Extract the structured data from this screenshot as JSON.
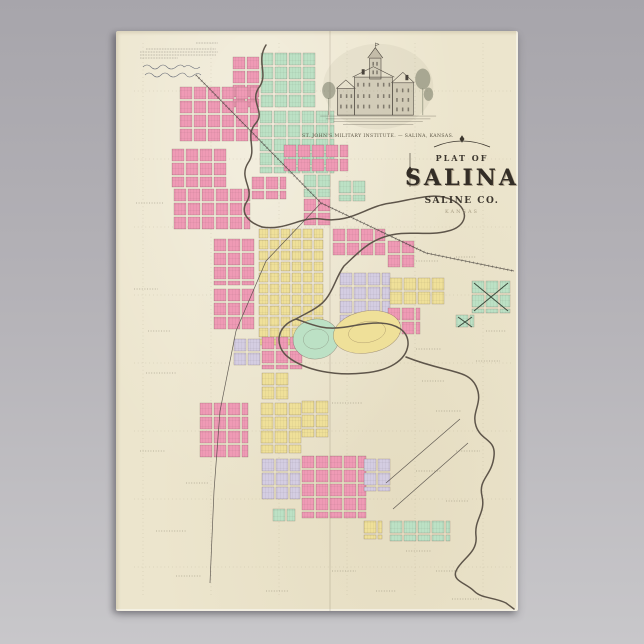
{
  "poster": {
    "title": {
      "plat_of": "PLAT OF",
      "city": "SALINA",
      "county": "SALINE CO.",
      "state": "KANSAS"
    },
    "engraving": {
      "caption": "ST. JOHN'S MILITARY INSTITUTE. — SALINA, KANSAS."
    }
  },
  "map": {
    "palette": {
      "pink": "#ef9ab5",
      "green": "#bce1c5",
      "yellow": "#efe099",
      "lavender": "#d4cde2",
      "paper": "#ece5cd",
      "river": "#5e554a",
      "rail": "#4a4440",
      "lot_line": "rgba(70,45,40,0.42)",
      "section_line": "#8b8266"
    },
    "clusters": [
      {
        "x": 117,
        "y": 26,
        "w": 26,
        "h": 50,
        "c": "pink"
      },
      {
        "x": 145,
        "y": 22,
        "w": 56,
        "h": 56,
        "c": "green"
      },
      {
        "x": 64,
        "y": 56,
        "w": 78,
        "h": 56,
        "c": "pink"
      },
      {
        "x": 144,
        "y": 80,
        "w": 74,
        "h": 62,
        "c": "green"
      },
      {
        "x": 56,
        "y": 118,
        "w": 56,
        "h": 38,
        "c": "pink"
      },
      {
        "x": 58,
        "y": 158,
        "w": 76,
        "h": 42,
        "c": "pink"
      },
      {
        "x": 168,
        "y": 114,
        "w": 64,
        "h": 26,
        "c": "pink"
      },
      {
        "x": 136,
        "y": 146,
        "w": 34,
        "h": 22,
        "c": "pink"
      },
      {
        "x": 188,
        "y": 144,
        "w": 30,
        "h": 22,
        "c": "green"
      },
      {
        "x": 188,
        "y": 168,
        "w": 30,
        "h": 26,
        "c": "pink"
      },
      {
        "x": 223,
        "y": 150,
        "w": 26,
        "h": 20,
        "c": "green"
      },
      {
        "x": 143,
        "y": 198,
        "w": 66,
        "h": 116,
        "c": "yellow",
        "cell": 11
      },
      {
        "x": 98,
        "y": 208,
        "w": 44,
        "h": 46,
        "c": "pink"
      },
      {
        "x": 98,
        "y": 258,
        "w": 44,
        "h": 44,
        "c": "pink"
      },
      {
        "x": 217,
        "y": 198,
        "w": 52,
        "h": 28,
        "c": "pink"
      },
      {
        "x": 272,
        "y": 210,
        "w": 26,
        "h": 26,
        "c": "pink"
      },
      {
        "x": 224,
        "y": 242,
        "w": 50,
        "h": 56,
        "c": "lavender"
      },
      {
        "x": 274,
        "y": 247,
        "w": 56,
        "h": 28,
        "c": "yellow"
      },
      {
        "x": 272,
        "y": 277,
        "w": 32,
        "h": 28,
        "c": "pink"
      },
      {
        "x": 356,
        "y": 250,
        "w": 38,
        "h": 32,
        "c": "green",
        "cem": true
      },
      {
        "x": 340,
        "y": 284,
        "w": 18,
        "h": 14,
        "c": "green",
        "cem": true
      },
      {
        "x": 146,
        "y": 306,
        "w": 44,
        "h": 32,
        "c": "pink"
      },
      {
        "x": 118,
        "y": 308,
        "w": 26,
        "h": 28,
        "c": "lavender"
      },
      {
        "x": 146,
        "y": 342,
        "w": 30,
        "h": 26,
        "c": "yellow"
      },
      {
        "x": 84,
        "y": 372,
        "w": 48,
        "h": 56,
        "c": "pink"
      },
      {
        "x": 145,
        "y": 372,
        "w": 40,
        "h": 50,
        "c": "yellow"
      },
      {
        "x": 186,
        "y": 370,
        "w": 26,
        "h": 36,
        "c": "yellow"
      },
      {
        "x": 146,
        "y": 428,
        "w": 38,
        "h": 44,
        "c": "lavender"
      },
      {
        "x": 186,
        "y": 425,
        "w": 64,
        "h": 62,
        "c": "pink"
      },
      {
        "x": 248,
        "y": 428,
        "w": 26,
        "h": 32,
        "c": "lavender"
      },
      {
        "x": 157,
        "y": 478,
        "w": 22,
        "h": 12,
        "c": "green"
      },
      {
        "x": 248,
        "y": 490,
        "w": 18,
        "h": 18,
        "c": "yellow"
      },
      {
        "x": 274,
        "y": 490,
        "w": 60,
        "h": 20,
        "c": "green"
      }
    ],
    "parks": [
      {
        "cx": 200,
        "cy": 308,
        "rx": 23,
        "ry": 20,
        "c": "green",
        "rot": -8
      },
      {
        "cx": 251,
        "cy": 301,
        "rx": 34,
        "ry": 21,
        "c": "yellow",
        "rot": -10
      }
    ],
    "rivers": [
      "M150,14 C140,30 152,42 144,55 C132,70 150,80 140,92 C128,105 142,118 132,132 C122,148 140,158 130,172 C124,183 134,192 146,196",
      "M146,196 C170,200 185,185 205,188 C235,193 250,175 275,172 C300,168 320,160 338,170 C355,180 350,196 332,200 C310,206 290,198 268,206 C250,212 240,224 228,235 C220,246 218,258 210,268 C202,278 190,282 180,288",
      "M180,288 C160,295 158,315 172,326 C190,340 220,345 248,342 C272,340 290,330 292,314 C293,300 280,292 262,292 C240,292 225,300 205,296 C195,294 186,290 180,288",
      "M290,326 C330,342 352,338 360,355 C368,372 355,380 360,395 C365,410 380,408 378,425 C376,445 362,448 366,465 C370,482 358,488 360,505 C362,522 345,528 340,540 C336,550 350,552 358,560 C366,568 378,566 390,572 L398,578"
    ],
    "railroads": [
      {
        "pts": [
          [
            80,
            44
          ],
          [
            205,
            172
          ],
          [
            310,
            222
          ],
          [
            398,
            240
          ]
        ],
        "ties": true
      },
      {
        "pts": [
          [
            205,
            172
          ],
          [
            150,
            230
          ],
          [
            120,
            300
          ],
          [
            104,
            380
          ],
          [
            98,
            460
          ],
          [
            94,
            552
          ]
        ],
        "ties": false
      },
      {
        "pts": [
          [
            277,
            478
          ],
          [
            352,
            412
          ]
        ],
        "ties": false
      },
      {
        "pts": [
          [
            270,
            452
          ],
          [
            344,
            388
          ]
        ],
        "ties": false
      }
    ],
    "section_lines": {
      "vx": [
        27,
        95,
        163,
        231,
        299,
        367
      ],
      "hy": [
        60,
        128,
        196,
        264,
        332,
        400,
        468,
        536
      ]
    },
    "label_marks": [
      [
        20,
        172,
        28
      ],
      [
        18,
        258,
        24
      ],
      [
        30,
        342,
        30
      ],
      [
        24,
        420,
        26
      ],
      [
        40,
        500,
        30
      ],
      [
        60,
        545,
        26
      ],
      [
        216,
        372,
        30
      ],
      [
        300,
        318,
        26
      ],
      [
        306,
        350,
        22
      ],
      [
        320,
        380,
        26
      ],
      [
        340,
        420,
        24
      ],
      [
        300,
        440,
        26
      ],
      [
        330,
        470,
        22
      ],
      [
        290,
        520,
        26
      ],
      [
        216,
        540,
        24
      ],
      [
        150,
        560,
        22
      ],
      [
        260,
        560,
        20
      ],
      [
        320,
        540,
        22
      ],
      [
        360,
        330,
        24
      ],
      [
        300,
        230,
        22
      ],
      [
        340,
        226,
        20
      ],
      [
        370,
        300,
        20
      ],
      [
        32,
        300,
        22
      ],
      [
        70,
        452,
        22
      ],
      [
        336,
        568,
        30
      ]
    ]
  }
}
